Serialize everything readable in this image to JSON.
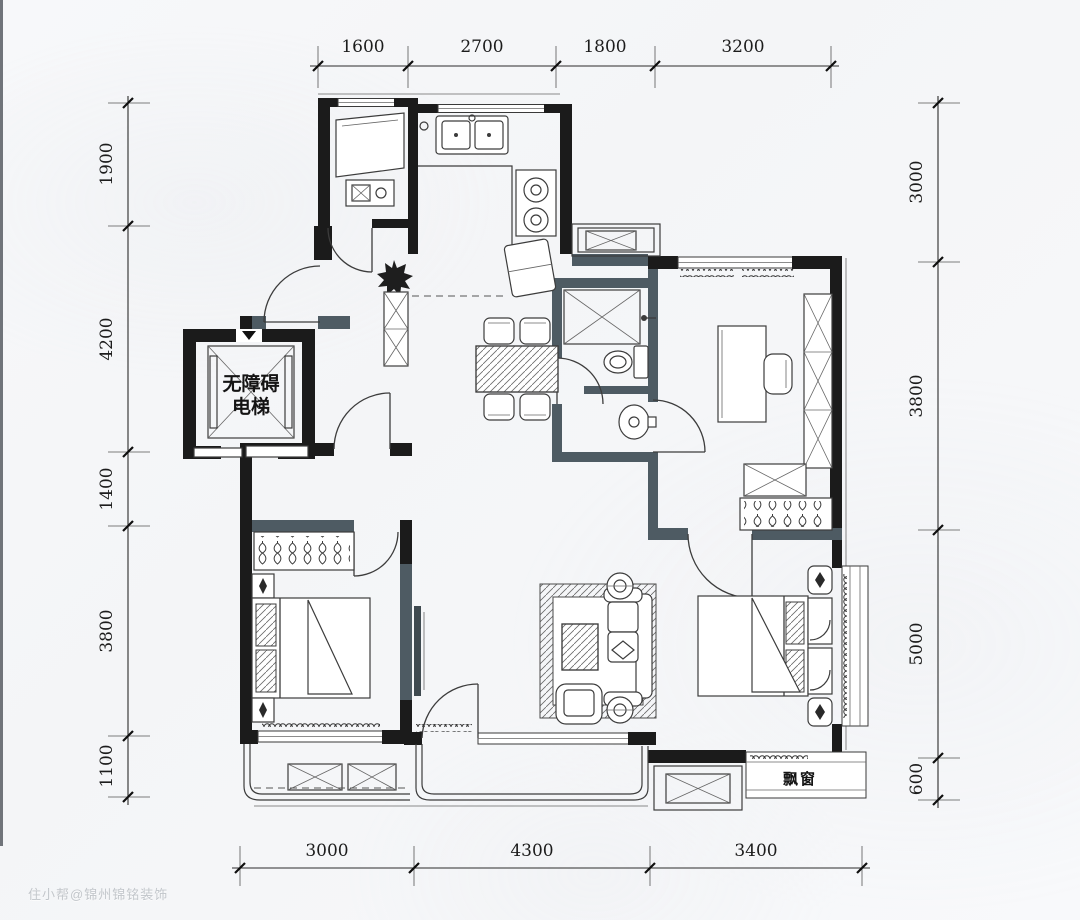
{
  "plan": {
    "dimensions": {
      "top": [
        "1600",
        "2700",
        "1800",
        "3200"
      ],
      "bottom": [
        "3000",
        "4300",
        "3400"
      ],
      "left": [
        "1900",
        "4200",
        "1400",
        "3800",
        "1100"
      ],
      "right": [
        "3000",
        "3800",
        "5000",
        "600"
      ]
    },
    "labels": {
      "elevator_line1": "无障碍",
      "elevator_line2": "电梯",
      "bay_window": "飘窗"
    },
    "watermark": "住小帮@锦州锦铭装饰",
    "colors": {
      "structural_wall": "#1b1b1b",
      "partition_wall": "#4e5b63",
      "dimension_text": "#1c1c1c",
      "background": "#f6f7f9"
    }
  }
}
